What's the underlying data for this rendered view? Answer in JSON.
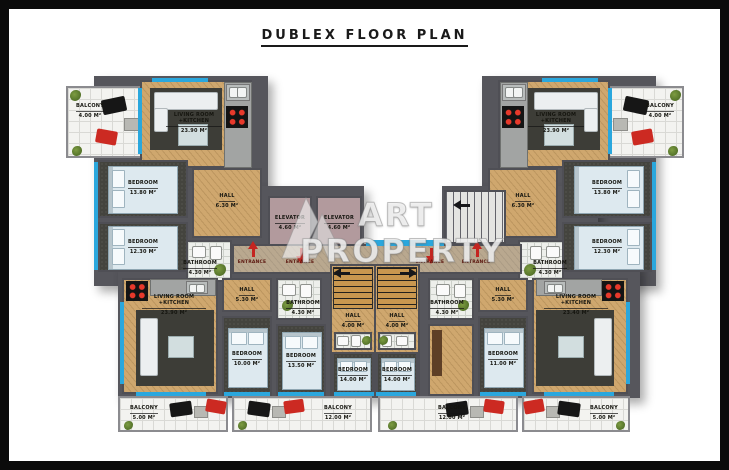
{
  "title": "DUBLEX FLOOR PLAN",
  "watermark": {
    "logo": "art-property-logo",
    "line1": "ART",
    "line2": "PROPERTY"
  },
  "entrance_label": "ENTRANCE",
  "colors": {
    "window_glass": "#2aa7dd",
    "wall": "#56565c",
    "entrance_arrow": "#c42520",
    "wood_floor": "#cfa76e"
  },
  "rooms": {
    "balcony_tl": {
      "name": "BALCONY",
      "area": "4.00 M²"
    },
    "living_tl": {
      "name": "LIVING ROOM +KITCHEN",
      "area": "23.90 M²"
    },
    "bedroom_tl1": {
      "name": "BEDROOM",
      "area": "13.80 M²"
    },
    "bedroom_tl2": {
      "name": "BEDROOM",
      "area": "12.30 M²"
    },
    "hall_tl": {
      "name": "HALL",
      "area": "6.30 M²"
    },
    "bathroom_tl": {
      "name": "BATHROOM",
      "area": "4.30 M²"
    },
    "balcony_tr": {
      "name": "BALCONY",
      "area": "4.00 M²"
    },
    "living_tr": {
      "name": "LIVING ROOM +KITCHEN",
      "area": "23.90 M²"
    },
    "bedroom_tr1": {
      "name": "BEDROOM",
      "area": "13.80 M²"
    },
    "bedroom_tr2": {
      "name": "BEDROOM",
      "area": "12.30 M²"
    },
    "hall_tr": {
      "name": "HALL",
      "area": "6.30 M²"
    },
    "bathroom_tr": {
      "name": "BATHROOM",
      "area": "4.30 M²"
    },
    "elevator_1": {
      "name": "ELEVATOR",
      "area": "4.60 M²"
    },
    "elevator_2": {
      "name": "ELEVATOR",
      "area": "4.60 M²"
    },
    "living_bl": {
      "name": "LIVING ROOM +KITCHEN",
      "area": "23.90 M²"
    },
    "hall_bl": {
      "name": "HALL",
      "area": "5.30 M²"
    },
    "bathroom_bl": {
      "name": "BATHROOM",
      "area": "4.30 M²"
    },
    "bedroom_b1": {
      "name": "BEDROOM",
      "area": "10.00 M²"
    },
    "bedroom_b2": {
      "name": "BEDROOM",
      "area": "13.50 M²"
    },
    "hall_bcl": {
      "name": "HALL",
      "area": "4.00 M²"
    },
    "bedroom_bcl": {
      "name": "BEDROOM",
      "area": "14.00 M²"
    },
    "hall_bcr": {
      "name": "HALL",
      "area": "4.00 M²"
    },
    "bedroom_bcr": {
      "name": "BEDROOM",
      "area": "14.00 M²"
    },
    "bathroom_br": {
      "name": "BATHROOM",
      "area": "4.30 M²"
    },
    "hall_br": {
      "name": "HALL",
      "area": "5.30 M²"
    },
    "bedroom_b5": {
      "name": "BEDROOM",
      "area": "11.00 M²"
    },
    "living_br": {
      "name": "LIVING ROOM +KITCHEN",
      "area": "23.40 M²"
    },
    "balcony_bl": {
      "name": "BALCONY",
      "area": "5.00 M²"
    },
    "balcony_bcl": {
      "name": "BALCONY",
      "area": "12.00 M²"
    },
    "balcony_bcr": {
      "name": "BALCONY",
      "area": "12.00 M²"
    },
    "balcony_br": {
      "name": "BALCONY",
      "area": "5.00 M²"
    }
  }
}
